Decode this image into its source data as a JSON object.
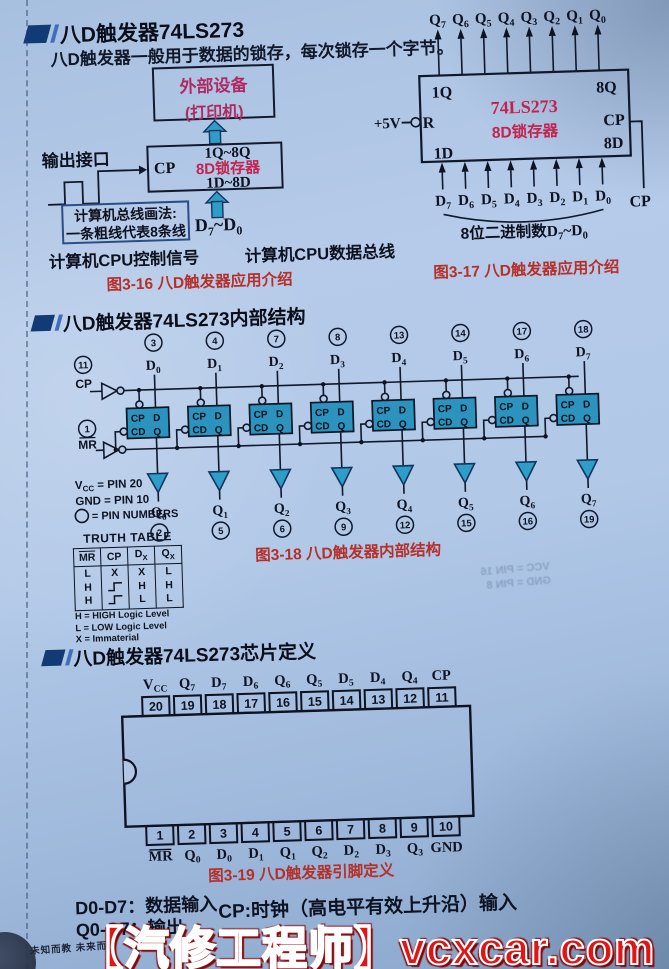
{
  "colors": {
    "slide_red": "#b5302a",
    "crimson": "#c22450",
    "magenta": "#b02a62",
    "teal": "#2e9dc8",
    "navy": "#16365e",
    "watermark_red": "#e51414"
  },
  "header": {
    "title": "八D触发器74LS273",
    "body": "八D触发器一般用于数据的锁存，每次锁存一个字节。"
  },
  "fig16": {
    "device1": "外部设备",
    "device2": "(打印机)",
    "latch_cp": "CP",
    "latch_top": "1Q~8Q",
    "latch_name": "8D锁存器",
    "latch_bottom": "1D~8D",
    "output_port": "输出接口",
    "bus_note1": "计算机总线画法:",
    "bus_note2": "一条粗线代表8条线",
    "cpu_ctrl": "计算机CPU控制信号",
    "cpu_data": "计算机CPU数据总线",
    "dbus": {
      "b1": "D",
      "s1": "7",
      "mid": "~",
      "b2": "D",
      "s2": "0"
    },
    "caption": "图3-16 八D触发器应用介绍"
  },
  "fig17": {
    "corner_tl": "1Q",
    "corner_tr": "8Q",
    "corner_bl": "1D",
    "name": "74LS273",
    "subtitle": "8D锁存器",
    "right_cp": "CP",
    "right_8d": "8D",
    "supply": "+5V",
    "reset_r": "R",
    "cp_out": "CP",
    "q_base": "Q",
    "d_base": "D",
    "q_subs": [
      "7",
      "6",
      "5",
      "4",
      "3",
      "2",
      "1",
      "0"
    ],
    "d_subs": [
      "7",
      "6",
      "5",
      "4",
      "3",
      "2",
      "1",
      "0"
    ],
    "brace_pre": "8位二进制数",
    "brace": {
      "b1": "D",
      "s1": "7",
      "mid": "~",
      "b2": "D",
      "s2": "0"
    },
    "caption": "图3-17 八D触发器应用介绍"
  },
  "section2": {
    "title": "八D触发器74LS273内部结构"
  },
  "fig18": {
    "cp_num": "11",
    "cp_label": "CP",
    "mr_num": "1",
    "mr_label": "MR",
    "ff": {
      "cp": "CP",
      "d": "D",
      "cd": "CD",
      "q": "Q"
    },
    "d_base": "D",
    "q_base": "Q",
    "units": [
      {
        "top": "3",
        "sub": "0",
        "bot": "2"
      },
      {
        "top": "4",
        "sub": "1",
        "bot": "5"
      },
      {
        "top": "7",
        "sub": "2",
        "bot": "6"
      },
      {
        "top": "8",
        "sub": "3",
        "bot": "9"
      },
      {
        "top": "13",
        "sub": "4",
        "bot": "12"
      },
      {
        "top": "14",
        "sub": "5",
        "bot": "15"
      },
      {
        "top": "17",
        "sub": "6",
        "bot": "16"
      },
      {
        "top": "18",
        "sub": "7",
        "bot": "19"
      }
    ],
    "note_vcc_b": "V",
    "note_vcc_s": "CC",
    "note_vcc_r": " = PIN 20",
    "note_gnd": "GND = PIN 10",
    "note_pin": " = PIN NUMBERS",
    "caption": "图3-18 八D触发器内部结构"
  },
  "truth_table": {
    "title": "TRUTH TABLE",
    "headers": [
      {
        "t": "MR",
        "bar": true
      },
      {
        "t": "CP",
        "bar": false
      },
      {
        "t": "D",
        "sub": "X"
      },
      {
        "t": "Q",
        "sub": "X"
      }
    ],
    "rows": [
      [
        "L",
        "X",
        "X",
        "L"
      ],
      [
        "H",
        "rising-edge",
        "H",
        "H"
      ],
      [
        "H",
        "rising-edge",
        "L",
        "L"
      ]
    ],
    "notes": [
      "H = HIGH Logic Level",
      "L = LOW Logic Level",
      "X = Immaterial"
    ]
  },
  "section3": {
    "title": "八D触发器74LS273芯片定义"
  },
  "fig19": {
    "top_pins": [
      {
        "num": "20",
        "b": "V",
        "s": "CC",
        "bar": false
      },
      {
        "num": "19",
        "b": "Q",
        "s": "7",
        "bar": false
      },
      {
        "num": "18",
        "b": "D",
        "s": "7",
        "bar": false
      },
      {
        "num": "17",
        "b": "D",
        "s": "6",
        "bar": false
      },
      {
        "num": "16",
        "b": "Q",
        "s": "6",
        "bar": false
      },
      {
        "num": "15",
        "b": "Q",
        "s": "5",
        "bar": false
      },
      {
        "num": "14",
        "b": "D",
        "s": "5",
        "bar": false
      },
      {
        "num": "13",
        "b": "D",
        "s": "4",
        "bar": false
      },
      {
        "num": "12",
        "b": "Q",
        "s": "4",
        "bar": false
      },
      {
        "num": "11",
        "b": "CP",
        "s": "",
        "bar": false
      }
    ],
    "bottom_pins": [
      {
        "num": "1",
        "b": "MR",
        "s": "",
        "bar": true
      },
      {
        "num": "2",
        "b": "Q",
        "s": "0",
        "bar": false
      },
      {
        "num": "3",
        "b": "D",
        "s": "0",
        "bar": false
      },
      {
        "num": "4",
        "b": "D",
        "s": "1",
        "bar": false
      },
      {
        "num": "5",
        "b": "Q",
        "s": "1",
        "bar": false
      },
      {
        "num": "6",
        "b": "Q",
        "s": "2",
        "bar": false
      },
      {
        "num": "7",
        "b": "D",
        "s": "2",
        "bar": false
      },
      {
        "num": "8",
        "b": "D",
        "s": "3",
        "bar": false
      },
      {
        "num": "9",
        "b": "Q",
        "s": "3",
        "bar": false
      },
      {
        "num": "10",
        "b": "GND",
        "s": "",
        "bar": false
      }
    ],
    "caption": "图3-19 八D触发器引脚定义"
  },
  "footer": {
    "d_note": "D0-D7：数据输入",
    "q_note": "Q0-Q7：输出",
    "cp_note": "CP:时钟（高电平有效上升沿）输入",
    "small_left": "未知而教 未来而学",
    "watermark": "【汽修工程师】vcxcar.com"
  },
  "ghost": {
    "line1": "VCC = PIN 16",
    "line2": "GND = PIN 8"
  }
}
